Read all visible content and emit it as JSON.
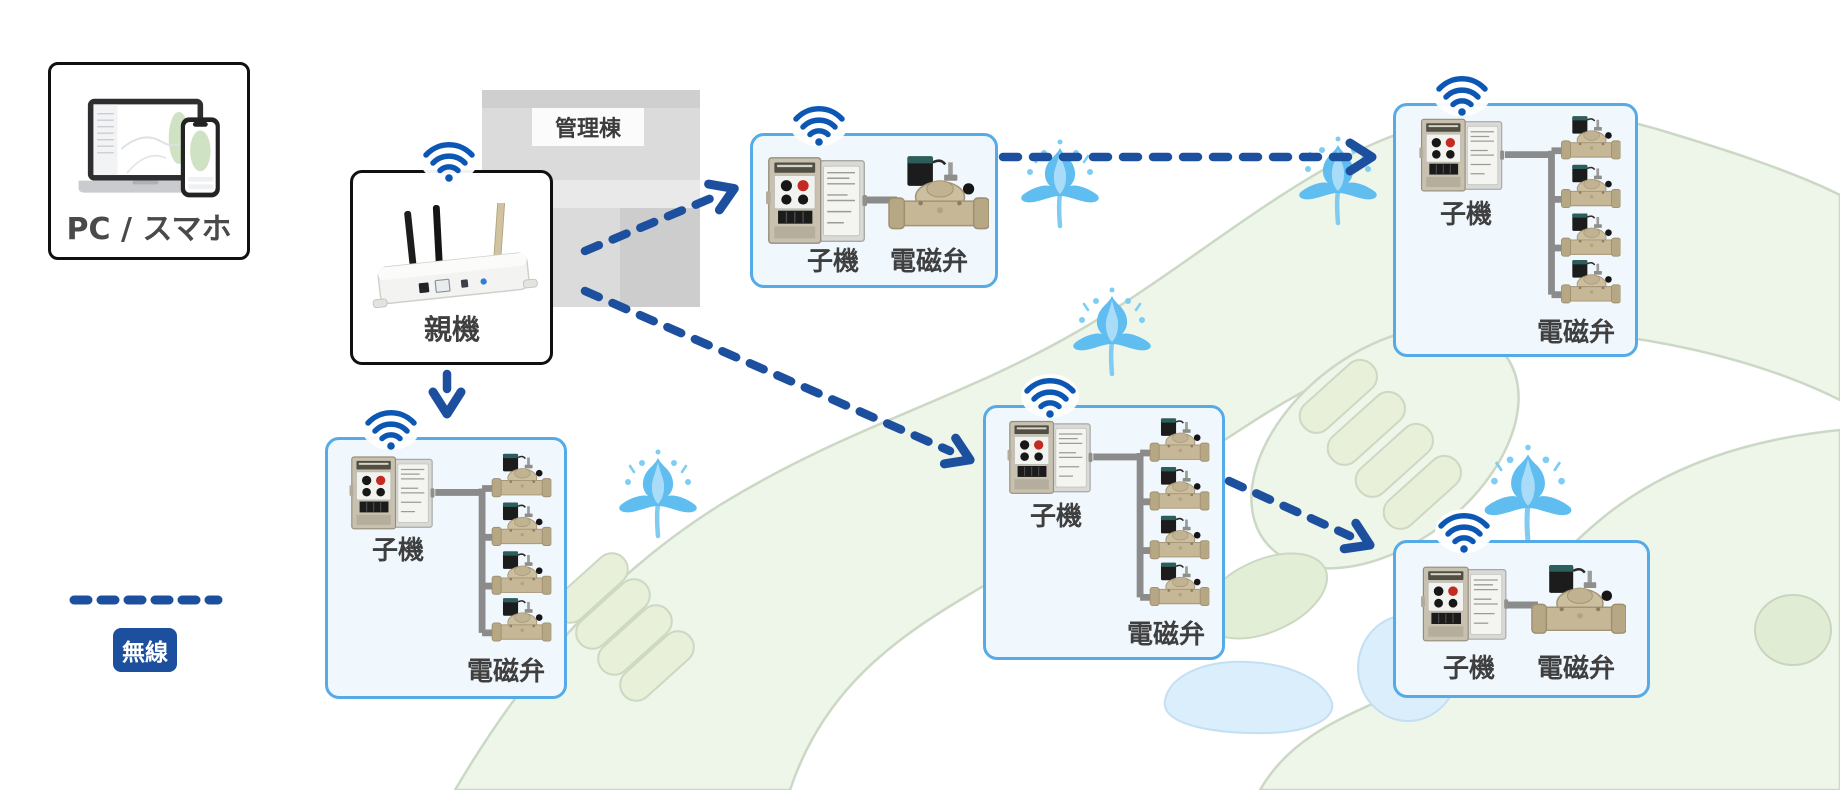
{
  "palette": {
    "arrow_blue": "#1d4f9f",
    "wifi_blue": "#0d57b4",
    "node_border_blue": "#55abe8",
    "node_background": "#f0f8fe",
    "fairway_green": "#eef5e9",
    "green_patch": "#e8f0da",
    "pond_blue": "#daeefb",
    "building_gray": "#dbdbdb",
    "cable_gray": "#8b8b8b",
    "label_text": "#3f3f3f"
  },
  "client_box": {
    "label": "PC / スマホ"
  },
  "building": {
    "label": "管理棟"
  },
  "base_station": {
    "label": "親機"
  },
  "legend": {
    "wireless_label": "無線"
  },
  "nodes": [
    {
      "id": "node-top-middle",
      "unit_label": "子機",
      "valve_label": "電磁弁",
      "valve_count": 1
    },
    {
      "id": "node-top-right",
      "unit_label": "子機",
      "valve_label": "電磁弁",
      "valve_count": 4
    },
    {
      "id": "node-bottom-left",
      "unit_label": "子機",
      "valve_label": "電磁弁",
      "valve_count": 4
    },
    {
      "id": "node-middle",
      "unit_label": "子機",
      "valve_label": "電磁弁",
      "valve_count": 4
    },
    {
      "id": "node-bottom-right",
      "unit_label": "子機",
      "valve_label": "電磁弁",
      "valve_count": 1
    }
  ],
  "connections": [
    {
      "from": "base-station",
      "to": "node-top-middle",
      "type": "wireless"
    },
    {
      "from": "base-station",
      "to": "node-bottom-left",
      "type": "wireless"
    },
    {
      "from": "base-station",
      "to": "node-middle",
      "type": "wireless"
    },
    {
      "from": "node-top-middle",
      "to": "node-top-right",
      "type": "wireless"
    },
    {
      "from": "node-middle",
      "to": "node-bottom-right",
      "type": "wireless"
    }
  ],
  "icons": {
    "wifi": "wifi-signal-icon",
    "sprinkler": "water-spray-icon",
    "base_station_device": "wireless-gateway-router",
    "node_device": "field-controller-box",
    "valve_device": "solenoid-valve",
    "client_devices": "laptop-and-smartphone"
  }
}
